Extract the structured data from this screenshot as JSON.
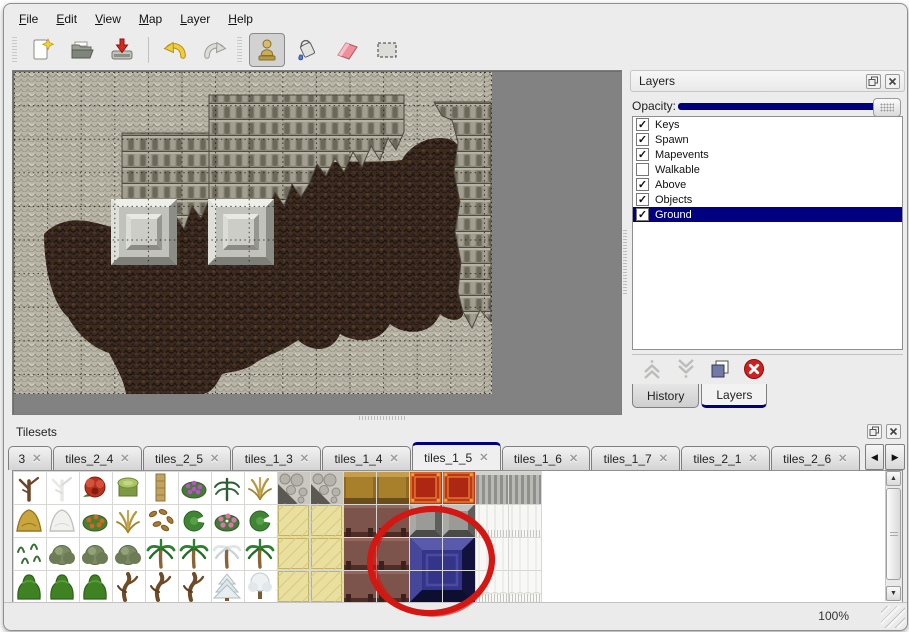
{
  "app": {
    "background": "#ececec",
    "accent_navy": "#000080",
    "canvas_gray": "#828282"
  },
  "menu_bar": {
    "items": [
      "File",
      "Edit",
      "View",
      "Map",
      "Layer",
      "Help"
    ]
  },
  "toolbar": {
    "groups": [
      {
        "handle": true,
        "separator": false,
        "buttons": [
          {
            "icon": "new-file-icon",
            "active": false
          },
          {
            "icon": "open-folder-icon",
            "active": false
          },
          {
            "icon": "save-icon",
            "active": false
          }
        ]
      },
      {
        "handle": false,
        "separator": true,
        "buttons": [
          {
            "icon": "undo-icon",
            "active": false
          },
          {
            "icon": "redo-icon",
            "active": false
          }
        ]
      },
      {
        "handle": true,
        "separator": false,
        "buttons": [
          {
            "icon": "stamp-tool-icon",
            "active": true
          },
          {
            "icon": "fill-tool-icon",
            "active": false
          },
          {
            "icon": "eraser-tool-icon",
            "active": false
          },
          {
            "icon": "select-tool-icon",
            "active": false
          }
        ]
      }
    ]
  },
  "map_view": {
    "grid_visible": true,
    "tile_size_px": 33,
    "terrain": [
      "light-stone",
      "dark-cliff",
      "brown-floor"
    ],
    "pillar_count": 2
  },
  "layers_panel": {
    "title": "Layers",
    "opacity_label": "Opacity:",
    "opacity_percent": 100,
    "layers": [
      {
        "name": "Keys",
        "checked": true,
        "selected": false
      },
      {
        "name": "Spawn",
        "checked": true,
        "selected": false
      },
      {
        "name": "Mapevents",
        "checked": true,
        "selected": false
      },
      {
        "name": "Walkable",
        "checked": false,
        "selected": false
      },
      {
        "name": "Above",
        "checked": true,
        "selected": false
      },
      {
        "name": "Objects",
        "checked": true,
        "selected": false
      },
      {
        "name": "Ground",
        "checked": true,
        "selected": true
      }
    ],
    "action_icons": [
      "move-up",
      "move-down",
      "duplicate",
      "delete"
    ],
    "bottom_tabs": [
      {
        "label": "History",
        "active": false
      },
      {
        "label": "Layers",
        "active": true
      }
    ]
  },
  "tilesets_panel": {
    "title": "Tilesets",
    "tabs": [
      {
        "label": "3",
        "active": false
      },
      {
        "label": "tiles_2_4",
        "active": false
      },
      {
        "label": "tiles_2_5",
        "active": false
      },
      {
        "label": "tiles_1_3",
        "active": false
      },
      {
        "label": "tiles_1_4",
        "active": false
      },
      {
        "label": "tiles_1_5",
        "active": true
      },
      {
        "label": "tiles_1_6",
        "active": false
      },
      {
        "label": "tiles_1_7",
        "active": false
      },
      {
        "label": "tiles_2_1",
        "active": false
      },
      {
        "label": "tiles_2_6",
        "active": false
      }
    ],
    "tile_grid": [
      [
        "dead-tree",
        "snow-branch",
        "red-flower",
        "moss-stump",
        "palm-trunk",
        "purple-flowers",
        "fern",
        "dry-plant",
        "stone-floor",
        "stone-floor",
        "table-top",
        "table-top",
        "red-carpet",
        "red-carpet",
        "gray-curtain",
        "gray-curtain"
      ],
      [
        "hay-pile",
        "snow-pile",
        "orange-flowers",
        "dry-grass",
        "leaf-litter",
        "lily-pad",
        "pink-flowers",
        "lily-pad",
        "mat",
        "mat",
        "table-front",
        "table-front",
        "metal-block",
        "metal-block",
        "white-curtain-top",
        "white-curtain-top"
      ],
      [
        "sprouts",
        "gray-bush",
        "gray-bush",
        "gray-bush",
        "palm-tree",
        "palm-tree",
        "snow-palm",
        "palm-tree",
        "mat",
        "mat",
        "table-front",
        "table-front",
        "blue-block",
        "blue-block",
        "white-curtain",
        "white-curtain"
      ],
      [
        "green-bush",
        "green-bush",
        "green-bush",
        "dead-trunk",
        "dead-trunk",
        "dead-trunk",
        "snow-pine",
        "snow-tree",
        "mat",
        "mat",
        "table-front",
        "table-front",
        "blue-block",
        "blue-block",
        "white-curtain-bottom",
        "white-curtain-bottom"
      ]
    ],
    "highlighted_tile": "blue-block"
  },
  "annotation": {
    "shape": "ellipse",
    "color": "#d31712"
  },
  "status_bar": {
    "zoom": "100%"
  }
}
